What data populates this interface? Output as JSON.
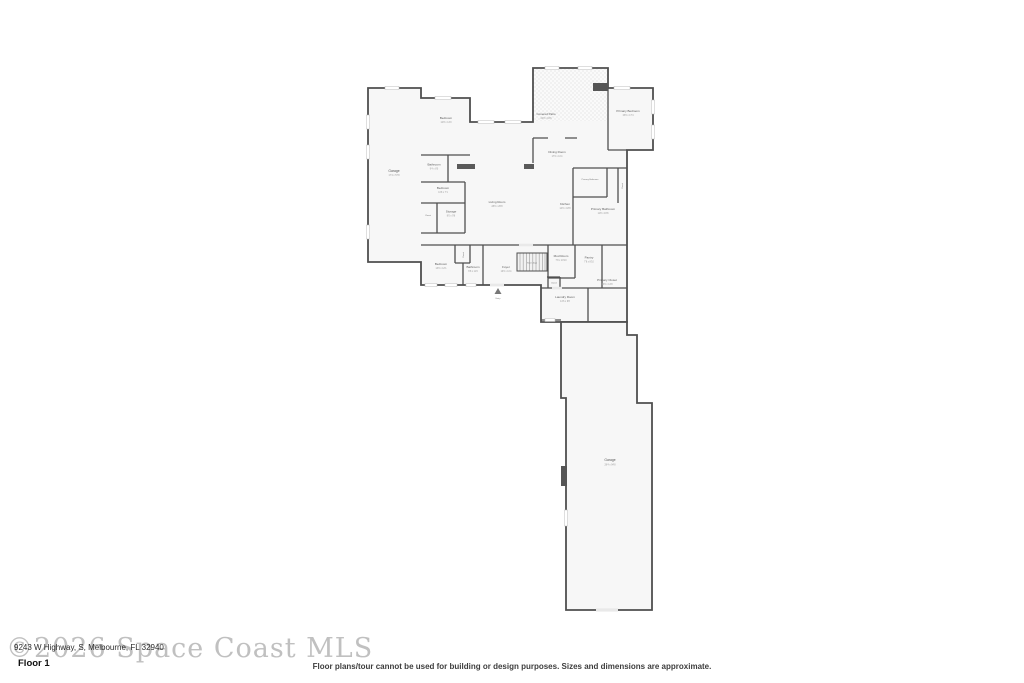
{
  "page": {
    "watermark": "©2026 Space Coast MLS",
    "address": "9243 W Highway, S, Melbourne, FL 32940",
    "floor_label": "Floor 1",
    "disclaimer": "Floor plans/tour cannot be used for building or design purposes. Sizes and dimensions are approximate."
  },
  "colors": {
    "wall": "#4f4f4f",
    "room_fill": "#f7f7f7",
    "watermark_gray": "#ababab",
    "text_dark": "#2b2b2b"
  },
  "plan": {
    "rooms": [
      {
        "name": "Garage",
        "dims": "17'4 x 57'8"
      },
      {
        "name": "Bedroom",
        "dims": "12'8 x 14'0"
      },
      {
        "name": "Bathroom",
        "dims": "9'4 x 8'0"
      },
      {
        "name": "Bedroom",
        "dims": "11'8 x 7'1"
      },
      {
        "name": "Closet",
        "dims": ""
      },
      {
        "name": "Storage",
        "dims": "8'0 x 9'6"
      },
      {
        "name": "Living Room",
        "dims": "28'0 x 26'8"
      },
      {
        "name": "Covered Patio",
        "dims": "24'8 x 16'6"
      },
      {
        "name": "Dining Room",
        "dims": "17'0 x 11'4"
      },
      {
        "name": "Primary Bedroom",
        "dims": "15'0 x 17'4"
      },
      {
        "name": "Primary Bathroom",
        "dims": ""
      },
      {
        "name": "Closet",
        "dims": ""
      },
      {
        "name": "Primary Bathroom",
        "dims": "11'8 x 16'8"
      },
      {
        "name": "Kitchen",
        "dims": "14'0 x 18'8"
      },
      {
        "name": "Bedroom",
        "dims": "13'0 x 12'1"
      },
      {
        "name": "Closet",
        "dims": ""
      },
      {
        "name": "Bathroom",
        "dims": "6'8 x 11'0"
      },
      {
        "name": "Foyer",
        "dims": "10'0 x 11'4"
      },
      {
        "name": "Stairs (Up)",
        "dims": ""
      },
      {
        "name": "Mud Room",
        "dims": "7'8 x 10'10"
      },
      {
        "name": "Pantry",
        "dims": "7'8 x 8'10"
      },
      {
        "name": "Closet",
        "dims": ""
      },
      {
        "name": "Primary Closet",
        "dims": "16'0 x 14'8"
      },
      {
        "name": "Laundry Room",
        "dims": "14'6 x 9'8"
      },
      {
        "name": "Entry",
        "dims": ""
      },
      {
        "name": "Garage",
        "dims": "28'4 x 94'8"
      }
    ]
  }
}
